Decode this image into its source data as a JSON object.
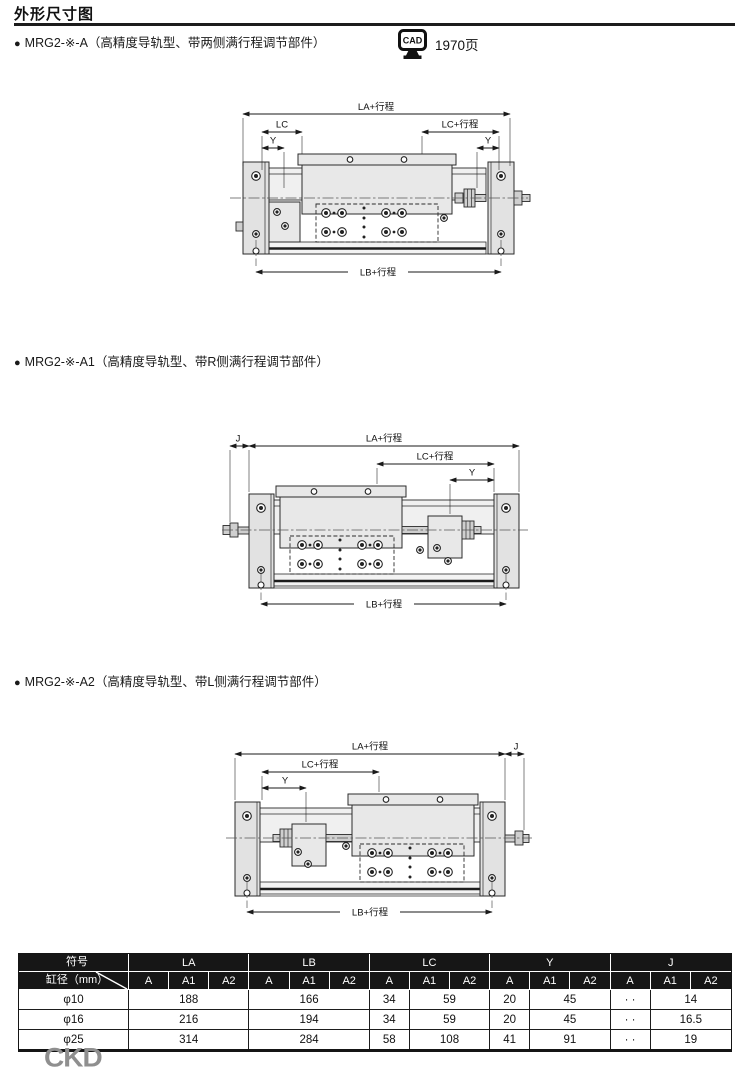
{
  "page": {
    "title": "外形尺寸图",
    "footer_logo": "CKD"
  },
  "cad": {
    "icon_label": "CAD",
    "page_ref": "1970页"
  },
  "sections": [
    {
      "bullet": "●",
      "heading": "MRG2-※-A（高精度导轨型、带两侧满行程调节部件）"
    },
    {
      "bullet": "●",
      "heading": "MRG2-※-A1（高精度导轨型、带R侧满行程调节部件）"
    },
    {
      "bullet": "●",
      "heading": "MRG2-※-A2（高精度导轨型、带L侧满行程调节部件）"
    }
  ],
  "drawings": {
    "a": {
      "la": "LA+行程",
      "lc_left": "LC",
      "lc_right": "LC+行程",
      "y_left": "Y",
      "y_right": "Y",
      "lb": "LB+行程"
    },
    "a1": {
      "j": "J",
      "la": "LA+行程",
      "lc": "LC+行程",
      "y": "Y",
      "lb": "LB+行程"
    },
    "a2": {
      "la": "LA+行程",
      "j": "J",
      "lc": "LC+行程",
      "y": "Y",
      "lb": "LB+行程"
    }
  },
  "table": {
    "corner": {
      "top": "符号",
      "bottom": "缸径（mm）"
    },
    "groups": [
      "LA",
      "LB",
      "LC",
      "Y",
      "J"
    ],
    "sub": [
      "A",
      "A1",
      "A2"
    ],
    "rows": [
      {
        "bore": "φ10",
        "la": "188",
        "lb": "166",
        "lc_a": "34",
        "lc_a1a2": "59",
        "y_a": "20",
        "y_a1a2": "45",
        "j_a": "· ·",
        "j_a1a2": "14"
      },
      {
        "bore": "φ16",
        "la": "216",
        "lb": "194",
        "lc_a": "34",
        "lc_a1a2": "59",
        "y_a": "20",
        "y_a1a2": "45",
        "j_a": "· ·",
        "j_a1a2": "16.5"
      },
      {
        "bore": "φ25",
        "la": "314",
        "lb": "284",
        "lc_a": "58",
        "lc_a1a2": "108",
        "y_a": "41",
        "y_a1a2": "91",
        "j_a": "· ·",
        "j_a1a2": "19"
      }
    ]
  }
}
